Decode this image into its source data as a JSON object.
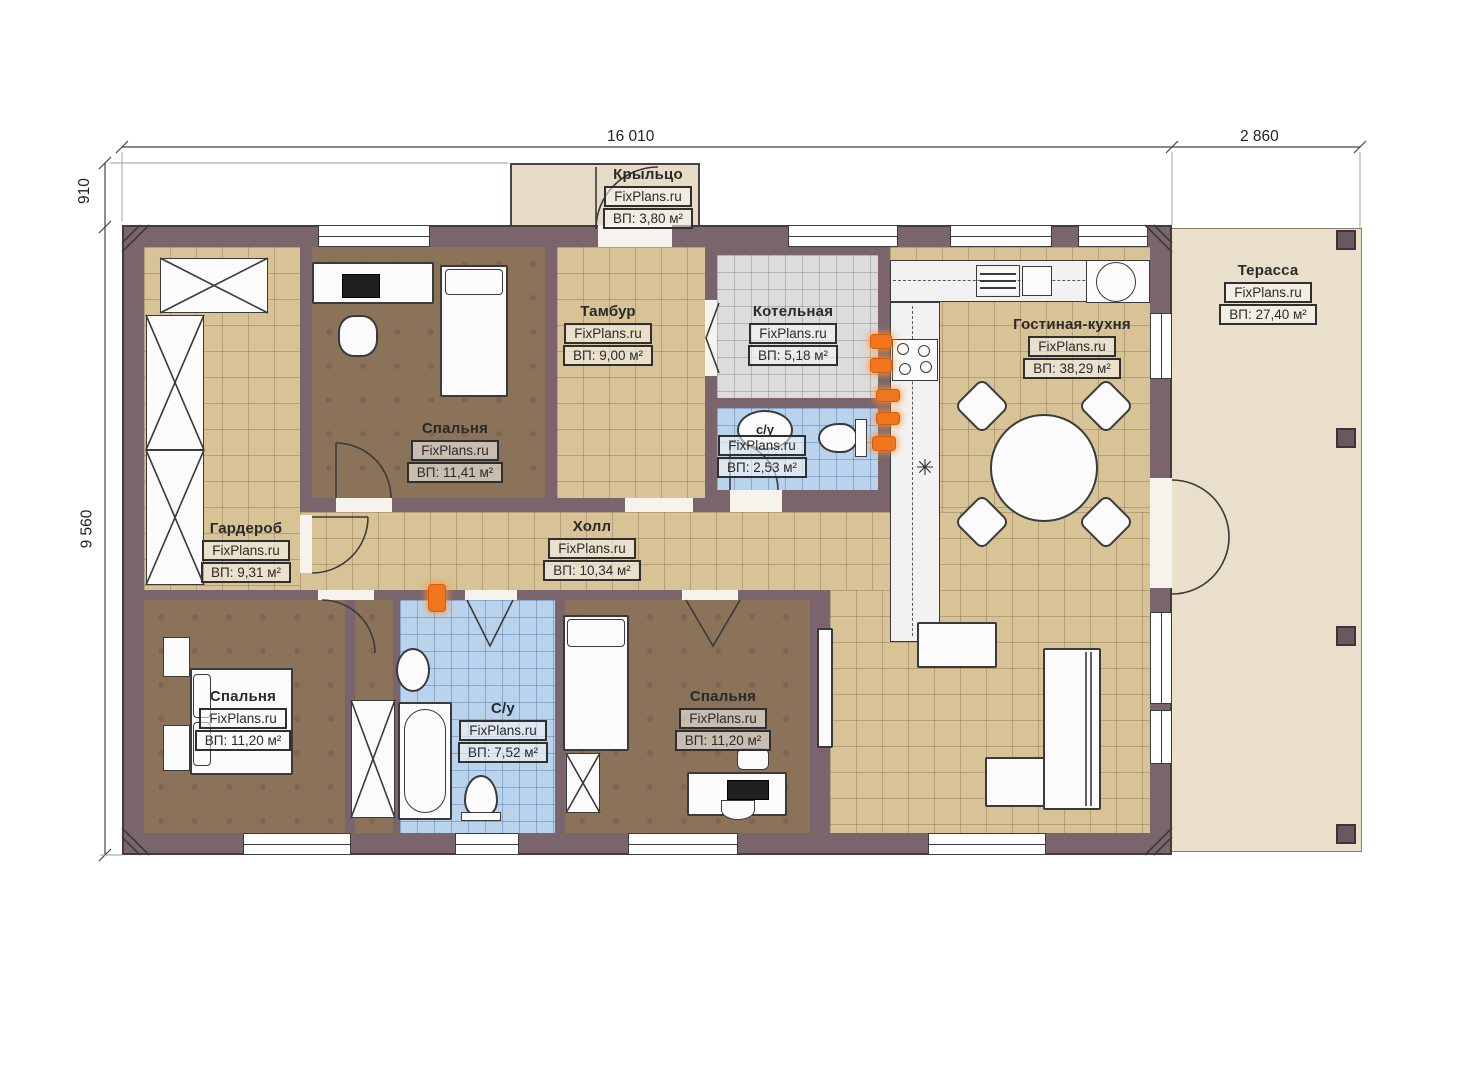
{
  "brand": {
    "watermark": "FixPlans.ru"
  },
  "dimensions": {
    "width_main": "16 010",
    "width_terrace": "2 860",
    "height_porch": "910",
    "height_main": "9 560"
  },
  "rooms": [
    {
      "id": "porch",
      "name": "Крыльцо",
      "area": "ВП: 3,80 м²"
    },
    {
      "id": "tambour",
      "name": "Тамбур",
      "area": "ВП: 9,00 м²"
    },
    {
      "id": "boiler",
      "name": "Котельная",
      "area": "ВП: 5,18 м²"
    },
    {
      "id": "bathroom-small",
      "name": "с/у",
      "area": "ВП: 2,53 м²"
    },
    {
      "id": "living-kitchen",
      "name": "Гостиная-кухня",
      "area": "ВП: 38,29 м²"
    },
    {
      "id": "terrace",
      "name": "Терасса",
      "area": "ВП: 27,40 м²"
    },
    {
      "id": "bedroom-top",
      "name": "Спальня",
      "area": "ВП: 11,41 м²"
    },
    {
      "id": "wardrobe",
      "name": "Гардероб",
      "area": "ВП: 9,31 м²"
    },
    {
      "id": "hall",
      "name": "Холл",
      "area": "ВП: 10,34 м²"
    },
    {
      "id": "bedroom-left",
      "name": "Спальня",
      "area": "ВП: 11,20 м²"
    },
    {
      "id": "bathroom-big",
      "name": "С/у",
      "area": "ВП: 7,52 м²"
    },
    {
      "id": "bedroom-mid",
      "name": "Спальня",
      "area": "ВП: 11,20 м²"
    }
  ],
  "icons": {
    "snowflake": "✳"
  },
  "colors": {
    "wall": "#7b656c",
    "floor_beige": "#d8c397",
    "floor_brown": "#8b7359",
    "tile_blue": "#b9d3ed",
    "tile_gray": "#dcdcdc",
    "terrace": "#e9dfca",
    "porch": "#e6dcc5",
    "radiator": "#f0761e",
    "line": "#3a3a3a"
  }
}
